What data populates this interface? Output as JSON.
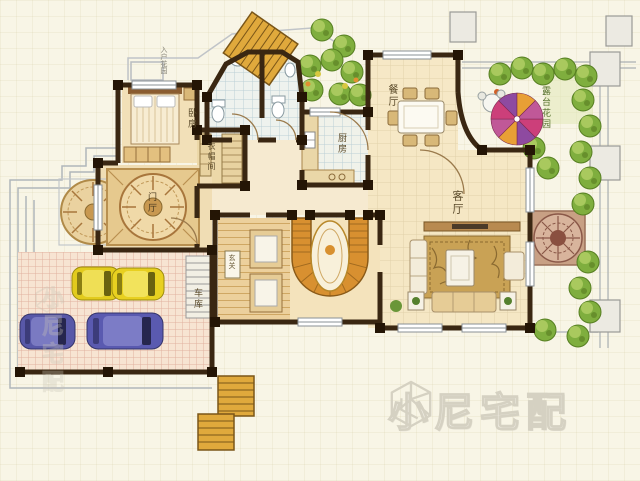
{
  "plan": {
    "labels": {
      "entry_garden": "入户花园",
      "bedroom": "卧房",
      "cloakroom": "衣帽间",
      "kitchen": "厨房",
      "dining_room": "餐厅",
      "living_room": "客厅",
      "terrace_garden": "露台花园",
      "foyer": "门厅",
      "entry_sign": "玄关",
      "garage": "车库"
    },
    "watermark": {
      "brand": "小尼宅配",
      "brand_side": "小尼宅配"
    },
    "colors": {
      "wall": "#3a2712",
      "floor_cream": "#f2e2bc",
      "bath_tile": "#eef2ee",
      "garage_tile": "#f7e4d2",
      "stair_wood": "#d89030",
      "car_yellow": "#e2cb1d",
      "car_blue": "#5a5ab0",
      "bush_green": "#7fae3e",
      "parasol_pink": "#cc3f7a",
      "watermark_gray": "#d5d1c2"
    }
  }
}
